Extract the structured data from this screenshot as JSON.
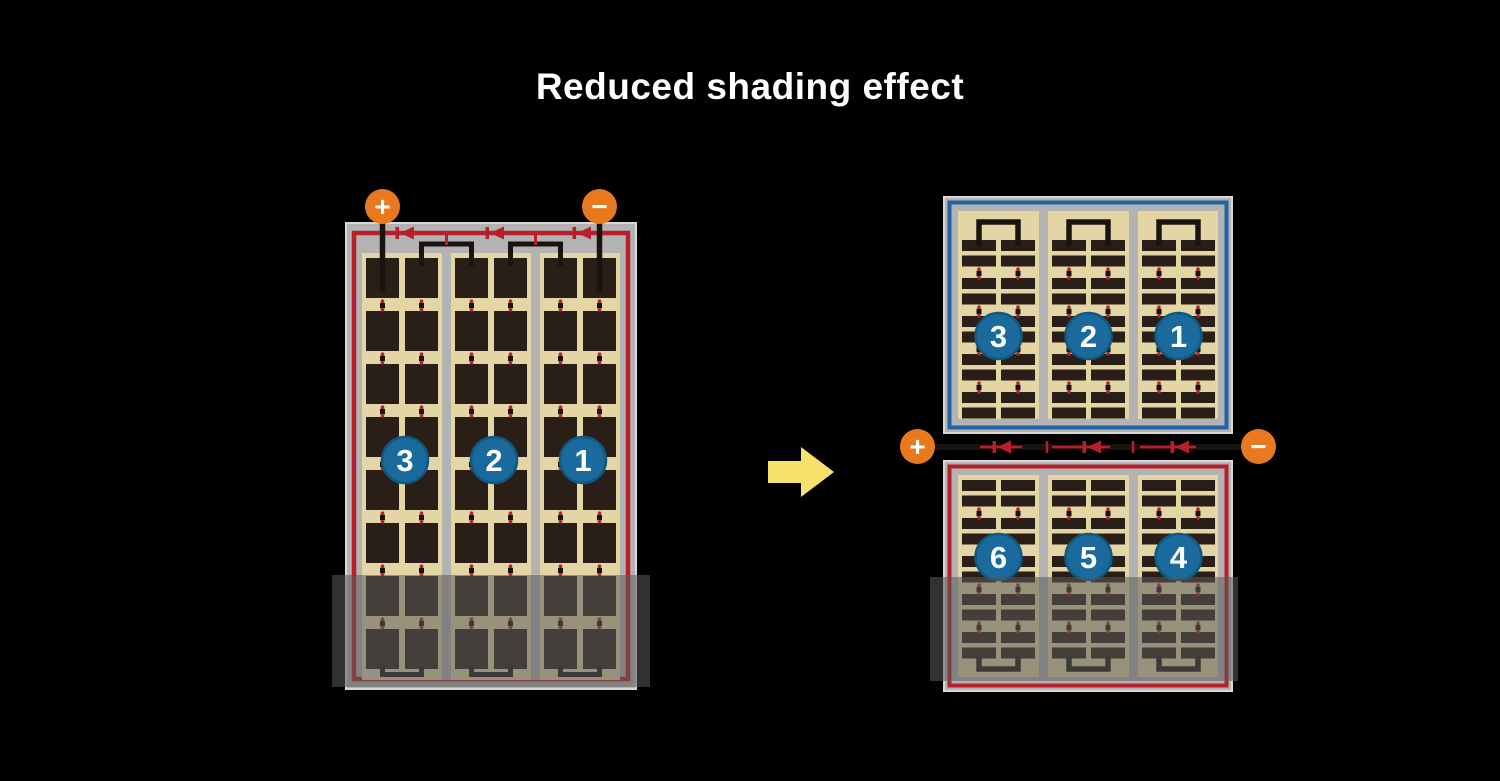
{
  "title": "Reduced shading effect",
  "colors": {
    "background": "#000000",
    "title_text": "#FFFFFF",
    "terminal_orange": "#E8791F",
    "frame_gray": "#B3B3B3",
    "frame_edge": "#D8D8D8",
    "red_circuit": "#B7202A",
    "blue_circuit": "#2363A4",
    "cell_field_tan": "#E4D6A4",
    "cell_dark": "#2A1F18",
    "wire_black": "#1A1410",
    "number_circle_blue": "#1B6A9E",
    "number_circle_rim": "#11587F",
    "number_text": "#FFFFFF",
    "arrow_yellow": "#F7E26E",
    "shade": "rgba(90,90,90,0.55)"
  },
  "left_module": {
    "plus_label": "+",
    "minus_label": "−",
    "panel": {
      "border": "red",
      "cell_shape": "square",
      "column_groups": 3,
      "subcolumns_per_group": 2,
      "rows": 8,
      "string_numbers": [
        "3",
        "2",
        "1"
      ],
      "bypass_diodes": 3,
      "shaded_region": "bottom two cell rows"
    }
  },
  "arrow": {
    "direction": "right"
  },
  "right_module": {
    "plus_label": "+",
    "minus_label": "−",
    "top_panel": {
      "border": "blue",
      "cell_shape": "half-cut-bar",
      "column_groups": 3,
      "subcolumns_per_group": 2,
      "string_numbers": [
        "3",
        "2",
        "1"
      ]
    },
    "bottom_panel": {
      "border": "red",
      "cell_shape": "half-cut-bar",
      "column_groups": 3,
      "subcolumns_per_group": 2,
      "string_numbers": [
        "6",
        "5",
        "4"
      ],
      "shaded_region": "bottom rows of lower panel"
    },
    "bypass_diodes": 3
  }
}
